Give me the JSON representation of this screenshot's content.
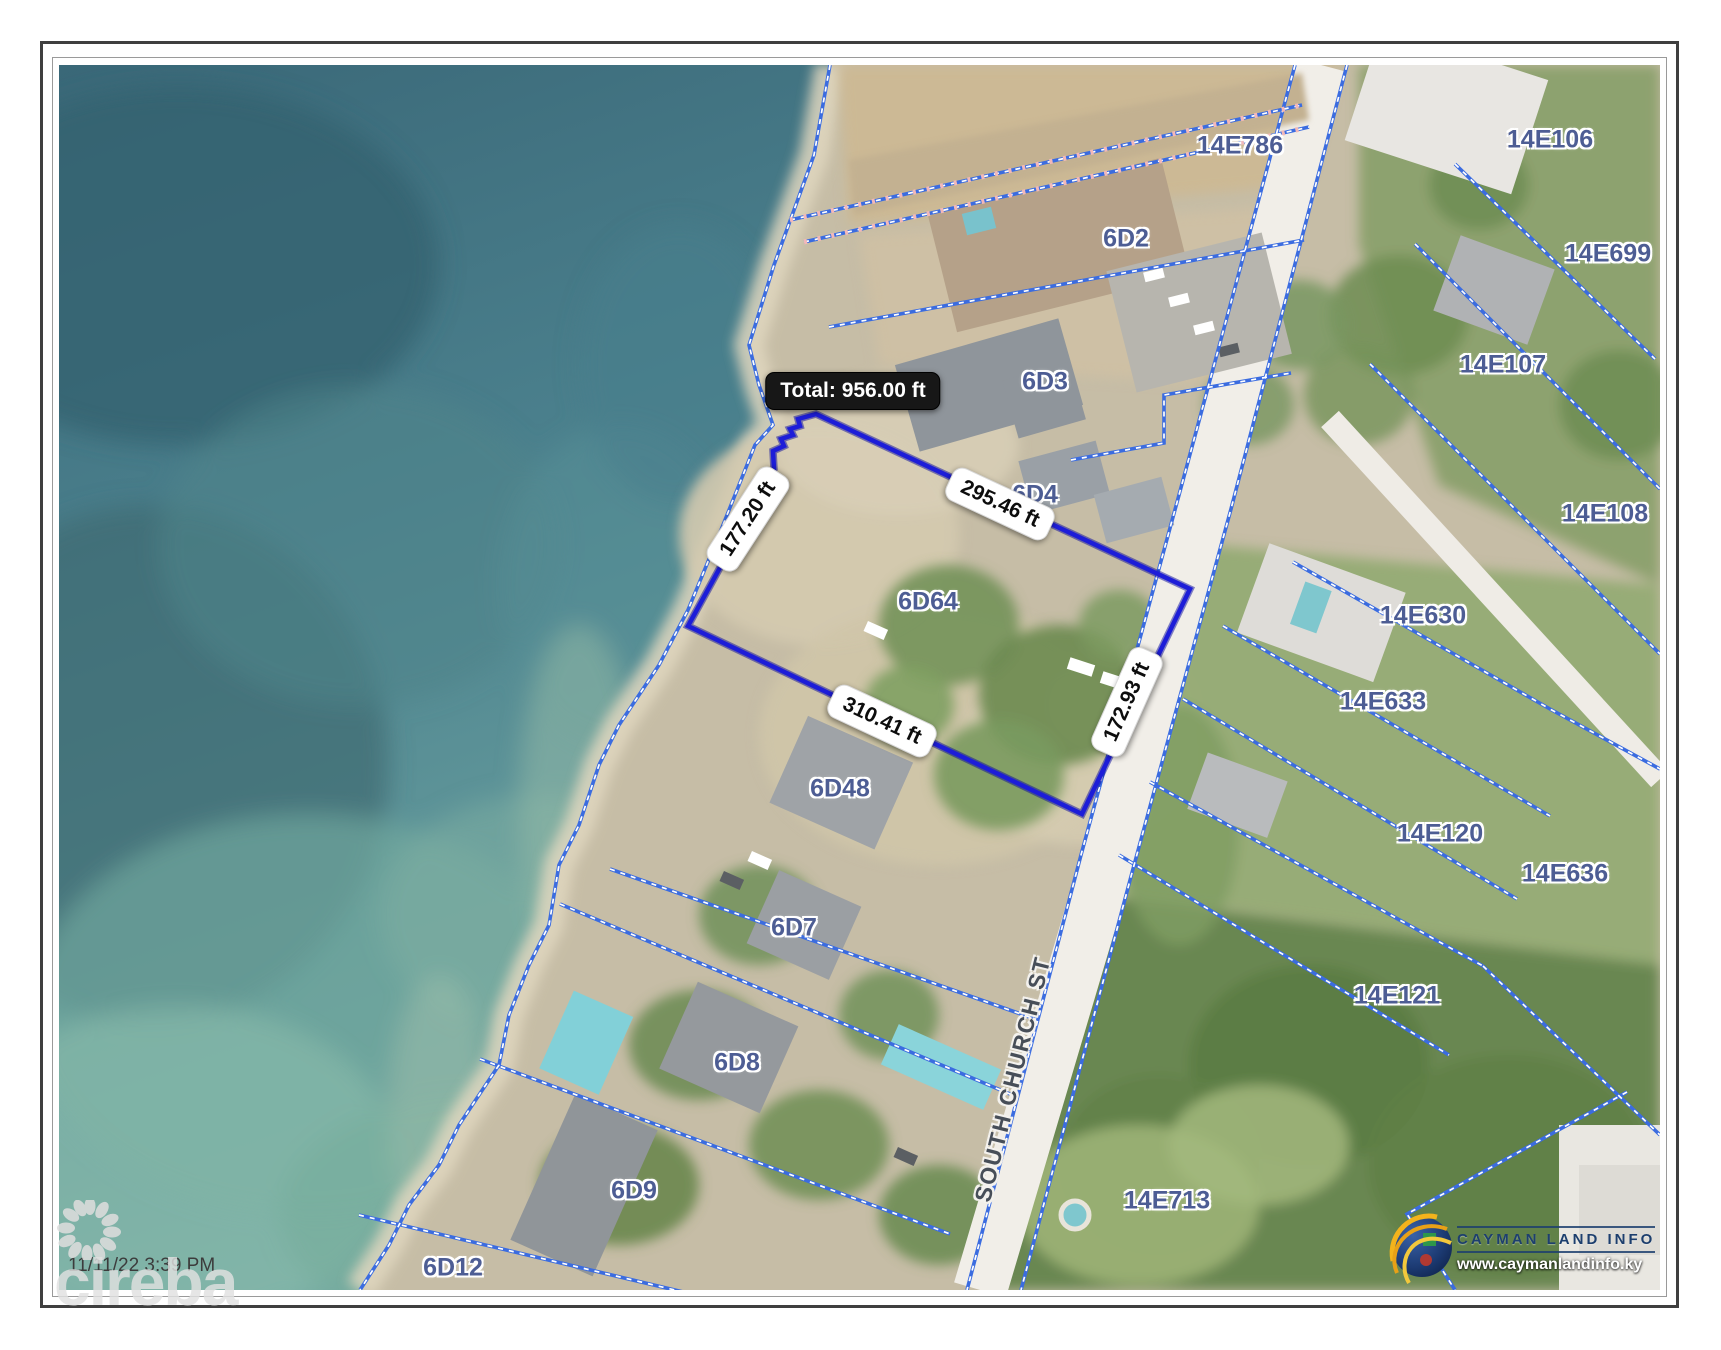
{
  "frame": {
    "timestamp": "11/11/22 3:39 PM"
  },
  "watermark": {
    "brand": "cireba"
  },
  "branding": {
    "title": "CAYMAN LAND INFO",
    "website": "www.caymanlandinfo.ky"
  },
  "map": {
    "street_label": {
      "text": "SOUTH CHURCH ST"
    },
    "parcels": [
      {
        "id": "14E786",
        "x": 1181,
        "y": 81
      },
      {
        "id": "6D2",
        "x": 1067,
        "y": 174
      },
      {
        "id": "6D3",
        "x": 986,
        "y": 317
      },
      {
        "id": "6D4",
        "x": 976,
        "y": 430
      },
      {
        "id": "6D64",
        "x": 869,
        "y": 537
      },
      {
        "id": "6D48",
        "x": 781,
        "y": 724
      },
      {
        "id": "6D7",
        "x": 735,
        "y": 863
      },
      {
        "id": "6D8",
        "x": 678,
        "y": 998
      },
      {
        "id": "6D9",
        "x": 575,
        "y": 1126
      },
      {
        "id": "6D12",
        "x": 394,
        "y": 1203
      },
      {
        "id": "14E713",
        "x": 1108,
        "y": 1136
      },
      {
        "id": "14E106",
        "x": 1491,
        "y": 75
      },
      {
        "id": "14E699",
        "x": 1549,
        "y": 189
      },
      {
        "id": "14E107",
        "x": 1444,
        "y": 300
      },
      {
        "id": "14E108",
        "x": 1546,
        "y": 449
      },
      {
        "id": "14E630",
        "x": 1364,
        "y": 551
      },
      {
        "id": "14E633",
        "x": 1324,
        "y": 637
      },
      {
        "id": "14E120",
        "x": 1381,
        "y": 769
      },
      {
        "id": "14E636",
        "x": 1506,
        "y": 809
      },
      {
        "id": "14E121",
        "x": 1338,
        "y": 931
      }
    ],
    "measurement": {
      "total_label": "Total: 956.00 ft",
      "segments": [
        {
          "label": "177.20 ft",
          "x": 689,
          "y": 454,
          "rotation": -57
        },
        {
          "label": "295.46 ft",
          "x": 941,
          "y": 439,
          "rotation": 25
        },
        {
          "label": "172.93 ft",
          "x": 1068,
          "y": 637,
          "rotation": -66
        },
        {
          "label": "310.41 ft",
          "x": 823,
          "y": 656,
          "rotation": 25
        }
      ],
      "polygon": [
        [
          757,
          349
        ],
        [
          1131,
          524
        ],
        [
          1023,
          749
        ],
        [
          629,
          561
        ],
        [
          715,
          404
        ],
        [
          714,
          386
        ],
        [
          725,
          381
        ],
        [
          722,
          374
        ],
        [
          734,
          370
        ],
        [
          731,
          364
        ],
        [
          741,
          361
        ],
        [
          739,
          354
        ]
      ],
      "line_color": "#1d1dd8"
    },
    "colors": {
      "ocean": "#47798a",
      "land": "#c6bda6",
      "forest": "#6e8d53",
      "road": "#f1eee8",
      "parcel_line": "#3b6ce0",
      "label_text": "#4d5d94"
    }
  }
}
